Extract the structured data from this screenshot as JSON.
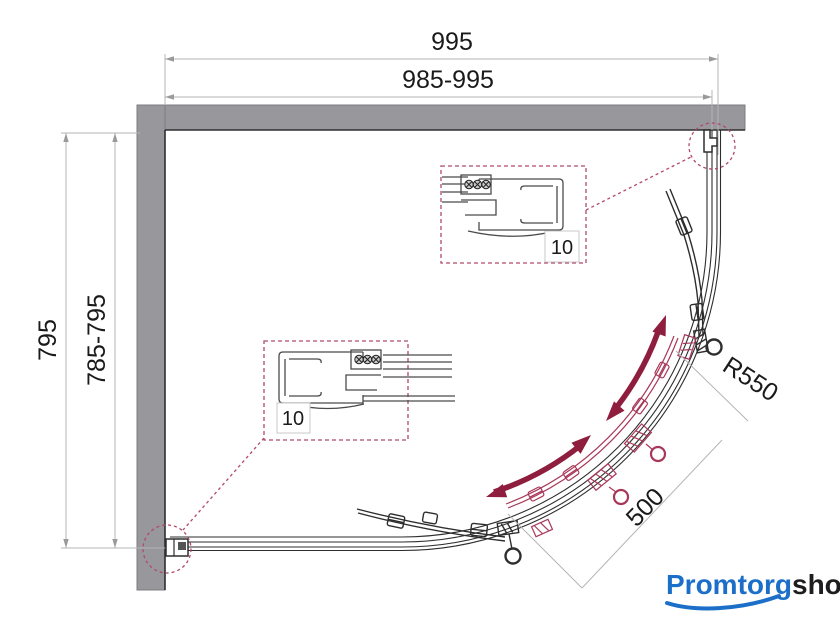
{
  "title": "Quadrant shower enclosure technical drawing (top view)",
  "dimensions": {
    "top_outer": "995",
    "top_inner": "985-995",
    "left_outer": "795",
    "left_inner": "785-795",
    "radius": "R550",
    "diagonal": "500"
  },
  "details": {
    "top_label": "10",
    "left_label": "10"
  },
  "logo": {
    "part1": "Promtorg",
    "part2": "shop"
  },
  "colors": {
    "wall_gray": "#98979c",
    "line_black": "#2e2e2e",
    "dimension_gray": "#b5b5b5",
    "arrow_maroon": "#8e1d3e",
    "door_red": "#a8385a",
    "callout_red": "#b04a68",
    "logo_blue": "#1b6fc9",
    "logo_dark": "#1d1d1f"
  }
}
